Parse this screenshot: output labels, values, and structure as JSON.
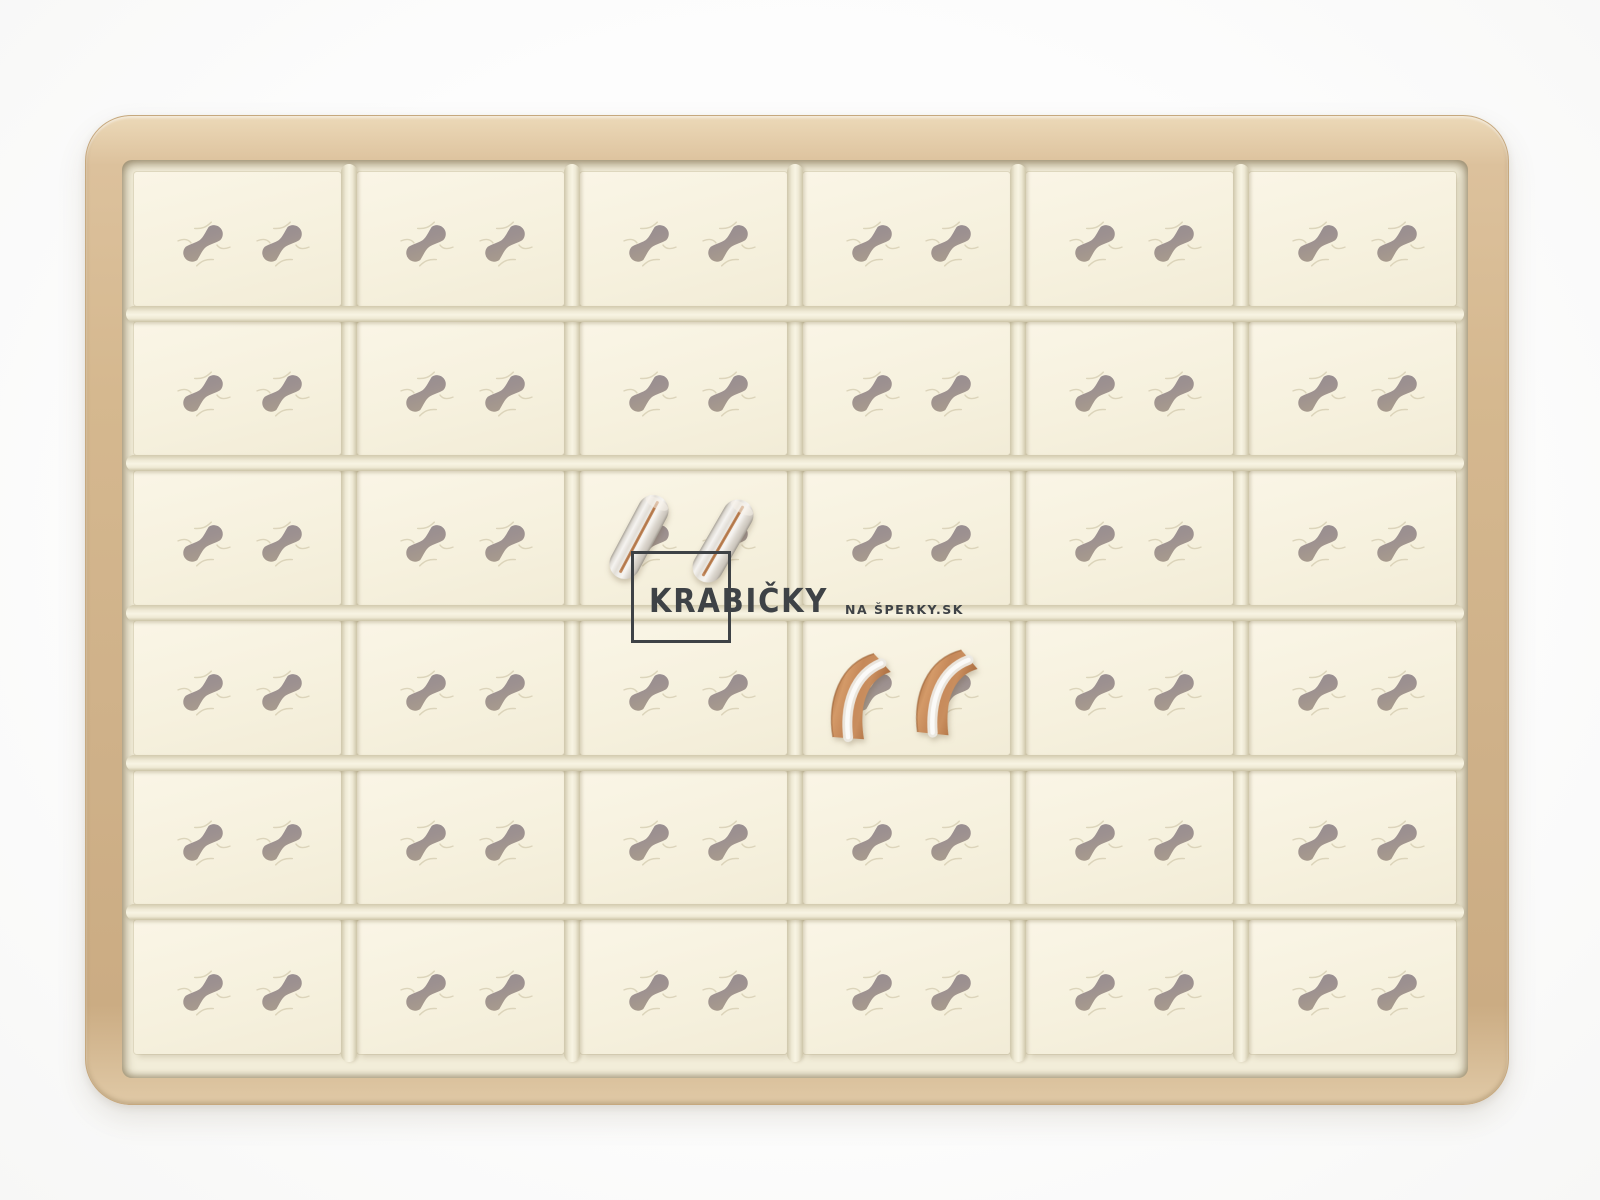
{
  "image_type": "product-photo",
  "alt": "Beige leatherette jewelry display tray with 36 cream compartments for rings and two pairs of wedding bands inserted",
  "watermark": {
    "title": "KRABIČKY",
    "subtitle": "NA ŠPERKY.SK",
    "color": "#3e4246"
  },
  "tray": {
    "rows": 6,
    "cols": 6,
    "slots_per_cell": 2,
    "total_slots": 72
  },
  "palette": {
    "background": "#fbfbfb",
    "frame_gold": "#d5b88f",
    "pad_ivory": "#f7f2e0",
    "rail_cream": "#f4efdd",
    "slot_taupe": "#9d9190",
    "ring_silver": "#efede9",
    "ring_copper": "#c58a59",
    "watermark_gray": "#3e4246"
  },
  "layout": {
    "slot_fx": [
      0.34,
      0.72
    ],
    "slot_fy": 0.54
  },
  "rings": {
    "pairs": [
      {
        "name": "silver wedding band pair with copper center stripe",
        "type": "A",
        "cell": {
          "row": 3,
          "col": 3
        },
        "items": [
          {
            "x": 622,
            "y": 490,
            "rot": 28
          },
          {
            "x": 706,
            "y": 494,
            "rot": 30
          }
        ]
      },
      {
        "name": "copper wedding band pair with silver center stripe",
        "type": "B",
        "cell": {
          "row": 4,
          "col": 4
        },
        "items": [
          {
            "x": 826,
            "y": 649,
            "rot": 4
          },
          {
            "x": 912,
            "y": 645,
            "rot": 6
          }
        ]
      }
    ]
  }
}
